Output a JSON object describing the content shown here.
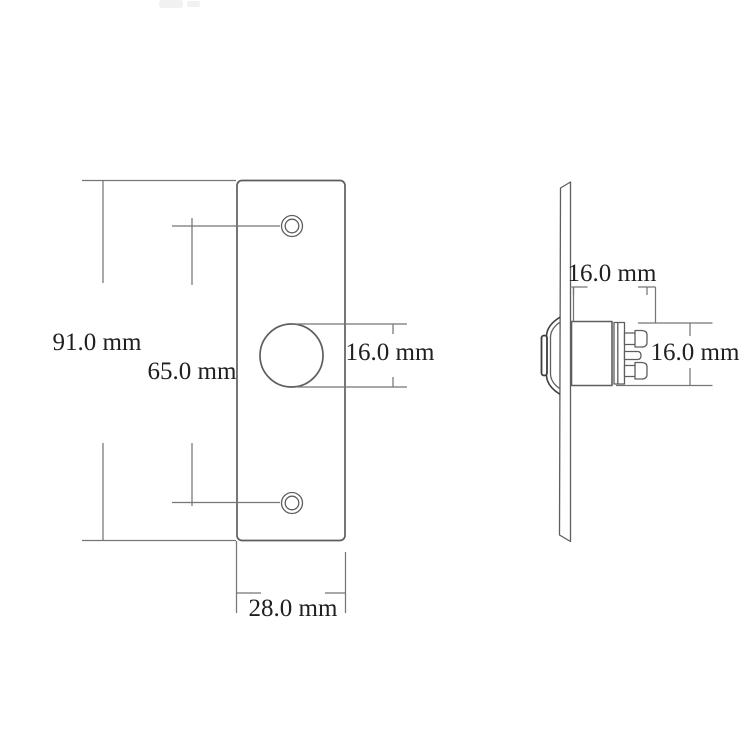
{
  "diagram": {
    "front_view": {
      "dim_height": "91.0 mm",
      "dim_hole_spacing": "65.0 mm",
      "dim_hole_diameter": "16.0 mm",
      "dim_plate_width": "28.0 mm"
    },
    "side_view": {
      "dim_body_depth": "16.0 mm",
      "dim_body_height": "16.0 mm"
    },
    "palette": {
      "background": "#ffffff",
      "part_outline": "#5e5e5e",
      "dimension_line": "#757575",
      "label_text": "#1f1f1f"
    }
  }
}
